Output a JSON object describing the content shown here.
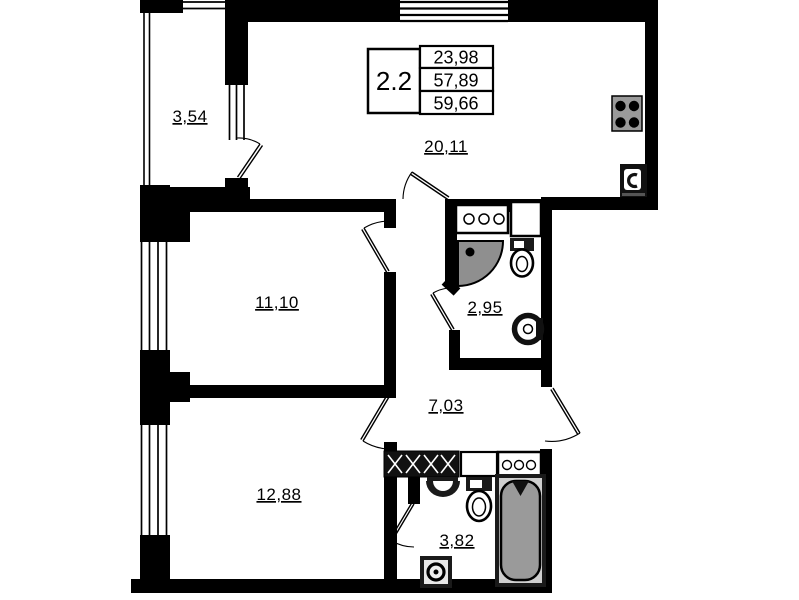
{
  "floor_plan": {
    "unit_info": {
      "type": "2.2",
      "values": [
        "23,98",
        "57,89",
        "59,66"
      ]
    },
    "rooms": {
      "balcony": "3,54",
      "kitchen_living": "20,11",
      "bedroom1": "11,10",
      "bathroom_small": "2,95",
      "hallway": "7,03",
      "bedroom2": "12,88",
      "bathroom_large": "3,82"
    },
    "colors": {
      "wall": "#000000",
      "background": "#ffffff",
      "fixture_gray": "#9a9a9a",
      "shower_gray": "#8f8f8f"
    },
    "fixture_icons": [
      "stove",
      "kitchen-sink",
      "counter-appliance",
      "vent-shaft",
      "shower",
      "toilet",
      "wall-sink",
      "wardrobe",
      "cabinet",
      "washbasin",
      "bathtub",
      "washing-machine"
    ]
  }
}
